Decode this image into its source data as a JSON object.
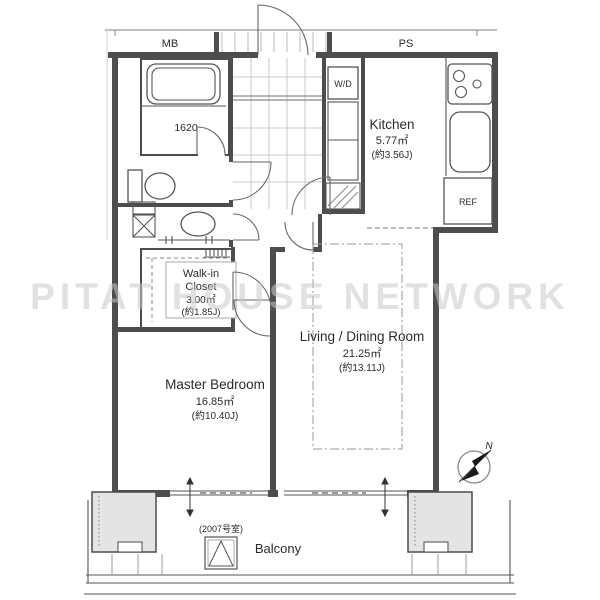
{
  "meta_labels": {
    "meter_box": "MB",
    "pipe_space": "PS"
  },
  "watermark": "PITAT HOUSE NETWORK",
  "compass": {
    "north_label": "N"
  },
  "rooms": {
    "bathroom": {
      "tub_size_label": "1620"
    },
    "washer_dryer": {
      "label": "W/D"
    },
    "kitchen": {
      "name": "Kitchen",
      "area_sqm": "5.77㎡",
      "area_tatami": "(約3.56J)"
    },
    "refrigerator": {
      "label": "REF"
    },
    "walk_in_closet": {
      "name_line1": "Walk-in",
      "name_line2": "Closet",
      "area_sqm": "3.00㎡",
      "area_tatami": "(約1.85J)"
    },
    "living_dining": {
      "name": "Living / Dining Room",
      "area_sqm": "21.25㎡",
      "area_tatami": "(約13.11J)"
    },
    "master_bedroom": {
      "name": "Master Bedroom",
      "area_sqm": "16.85㎡",
      "area_tatami": "(約10.40J)"
    },
    "balcony": {
      "name": "Balcony",
      "unit_note": "(2007号室)"
    }
  },
  "colors": {
    "wall": "#4d4d4d",
    "line": "#555555",
    "grid_line": "#c8c8c8",
    "pillar_fill": "#e4e4e4",
    "watermark": "#c9c9c9",
    "text": "#2b2b2b"
  }
}
